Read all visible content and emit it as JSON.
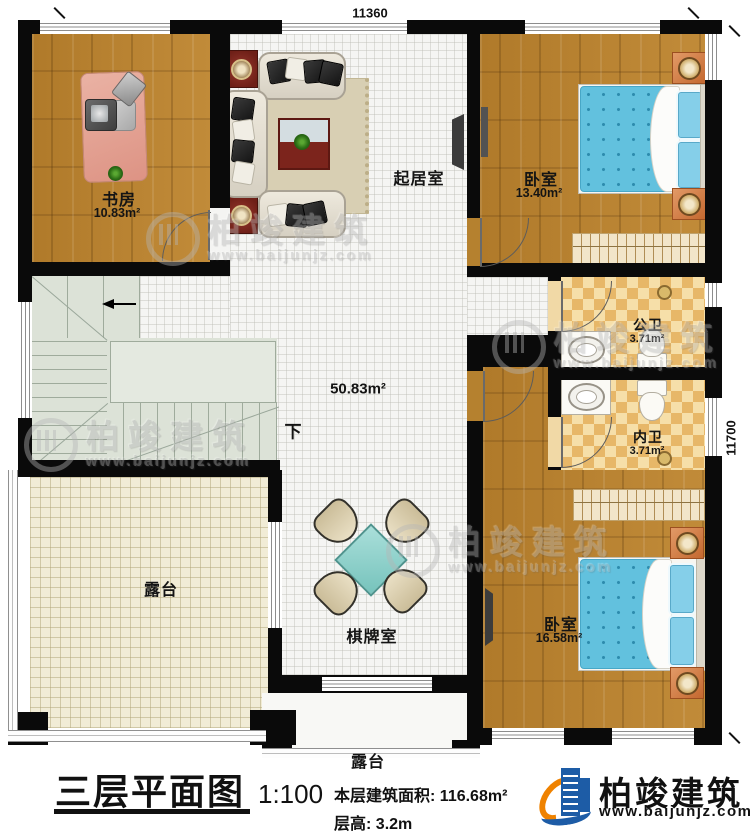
{
  "plan": {
    "dim_top": "11360",
    "dim_right": "11700",
    "rooms": {
      "study": {
        "label": "书房",
        "area": "10.83m²"
      },
      "living": {
        "label": "起居室"
      },
      "bedroom1": {
        "label": "卧室",
        "area": "13.40m²"
      },
      "public_bath": {
        "label": "公卫",
        "area": "3.71m²"
      },
      "private_bath": {
        "label": "内卫",
        "area": "3.71m²"
      },
      "bedroom2": {
        "label": "卧室",
        "area": "16.58m²"
      },
      "terrace": {
        "label": "露台"
      },
      "terrace_bottom": {
        "label": "露台"
      },
      "game_room": {
        "label": "棋牌室"
      },
      "hall": {
        "area": "50.83m²"
      }
    },
    "stairs": {
      "down_label": "下"
    }
  },
  "title_block": {
    "title": "三层平面图",
    "scale": "1:100",
    "area_label": "本层建筑面积:",
    "area_value": "116.68m²",
    "height_label": "层高:",
    "height_value": "3.2m"
  },
  "brand": {
    "name": "柏竣建筑",
    "site": "www.baijunjz.com"
  },
  "watermark": {
    "name": "柏竣建筑",
    "site": "www.baijunjz.com"
  },
  "colors": {
    "wall": "#0a0a0a",
    "wood_floor": "#b5812f",
    "tile_light": "#f6dfa9",
    "tile_dark": "#e7b768",
    "bed_blue": "#62c1de",
    "terrace_floor": "#f1ecd6",
    "stairs": "#dce2d7",
    "game_table": "#8fd2cc",
    "brand_blue": "#1d5ca6",
    "brand_orange": "#ef8200"
  }
}
